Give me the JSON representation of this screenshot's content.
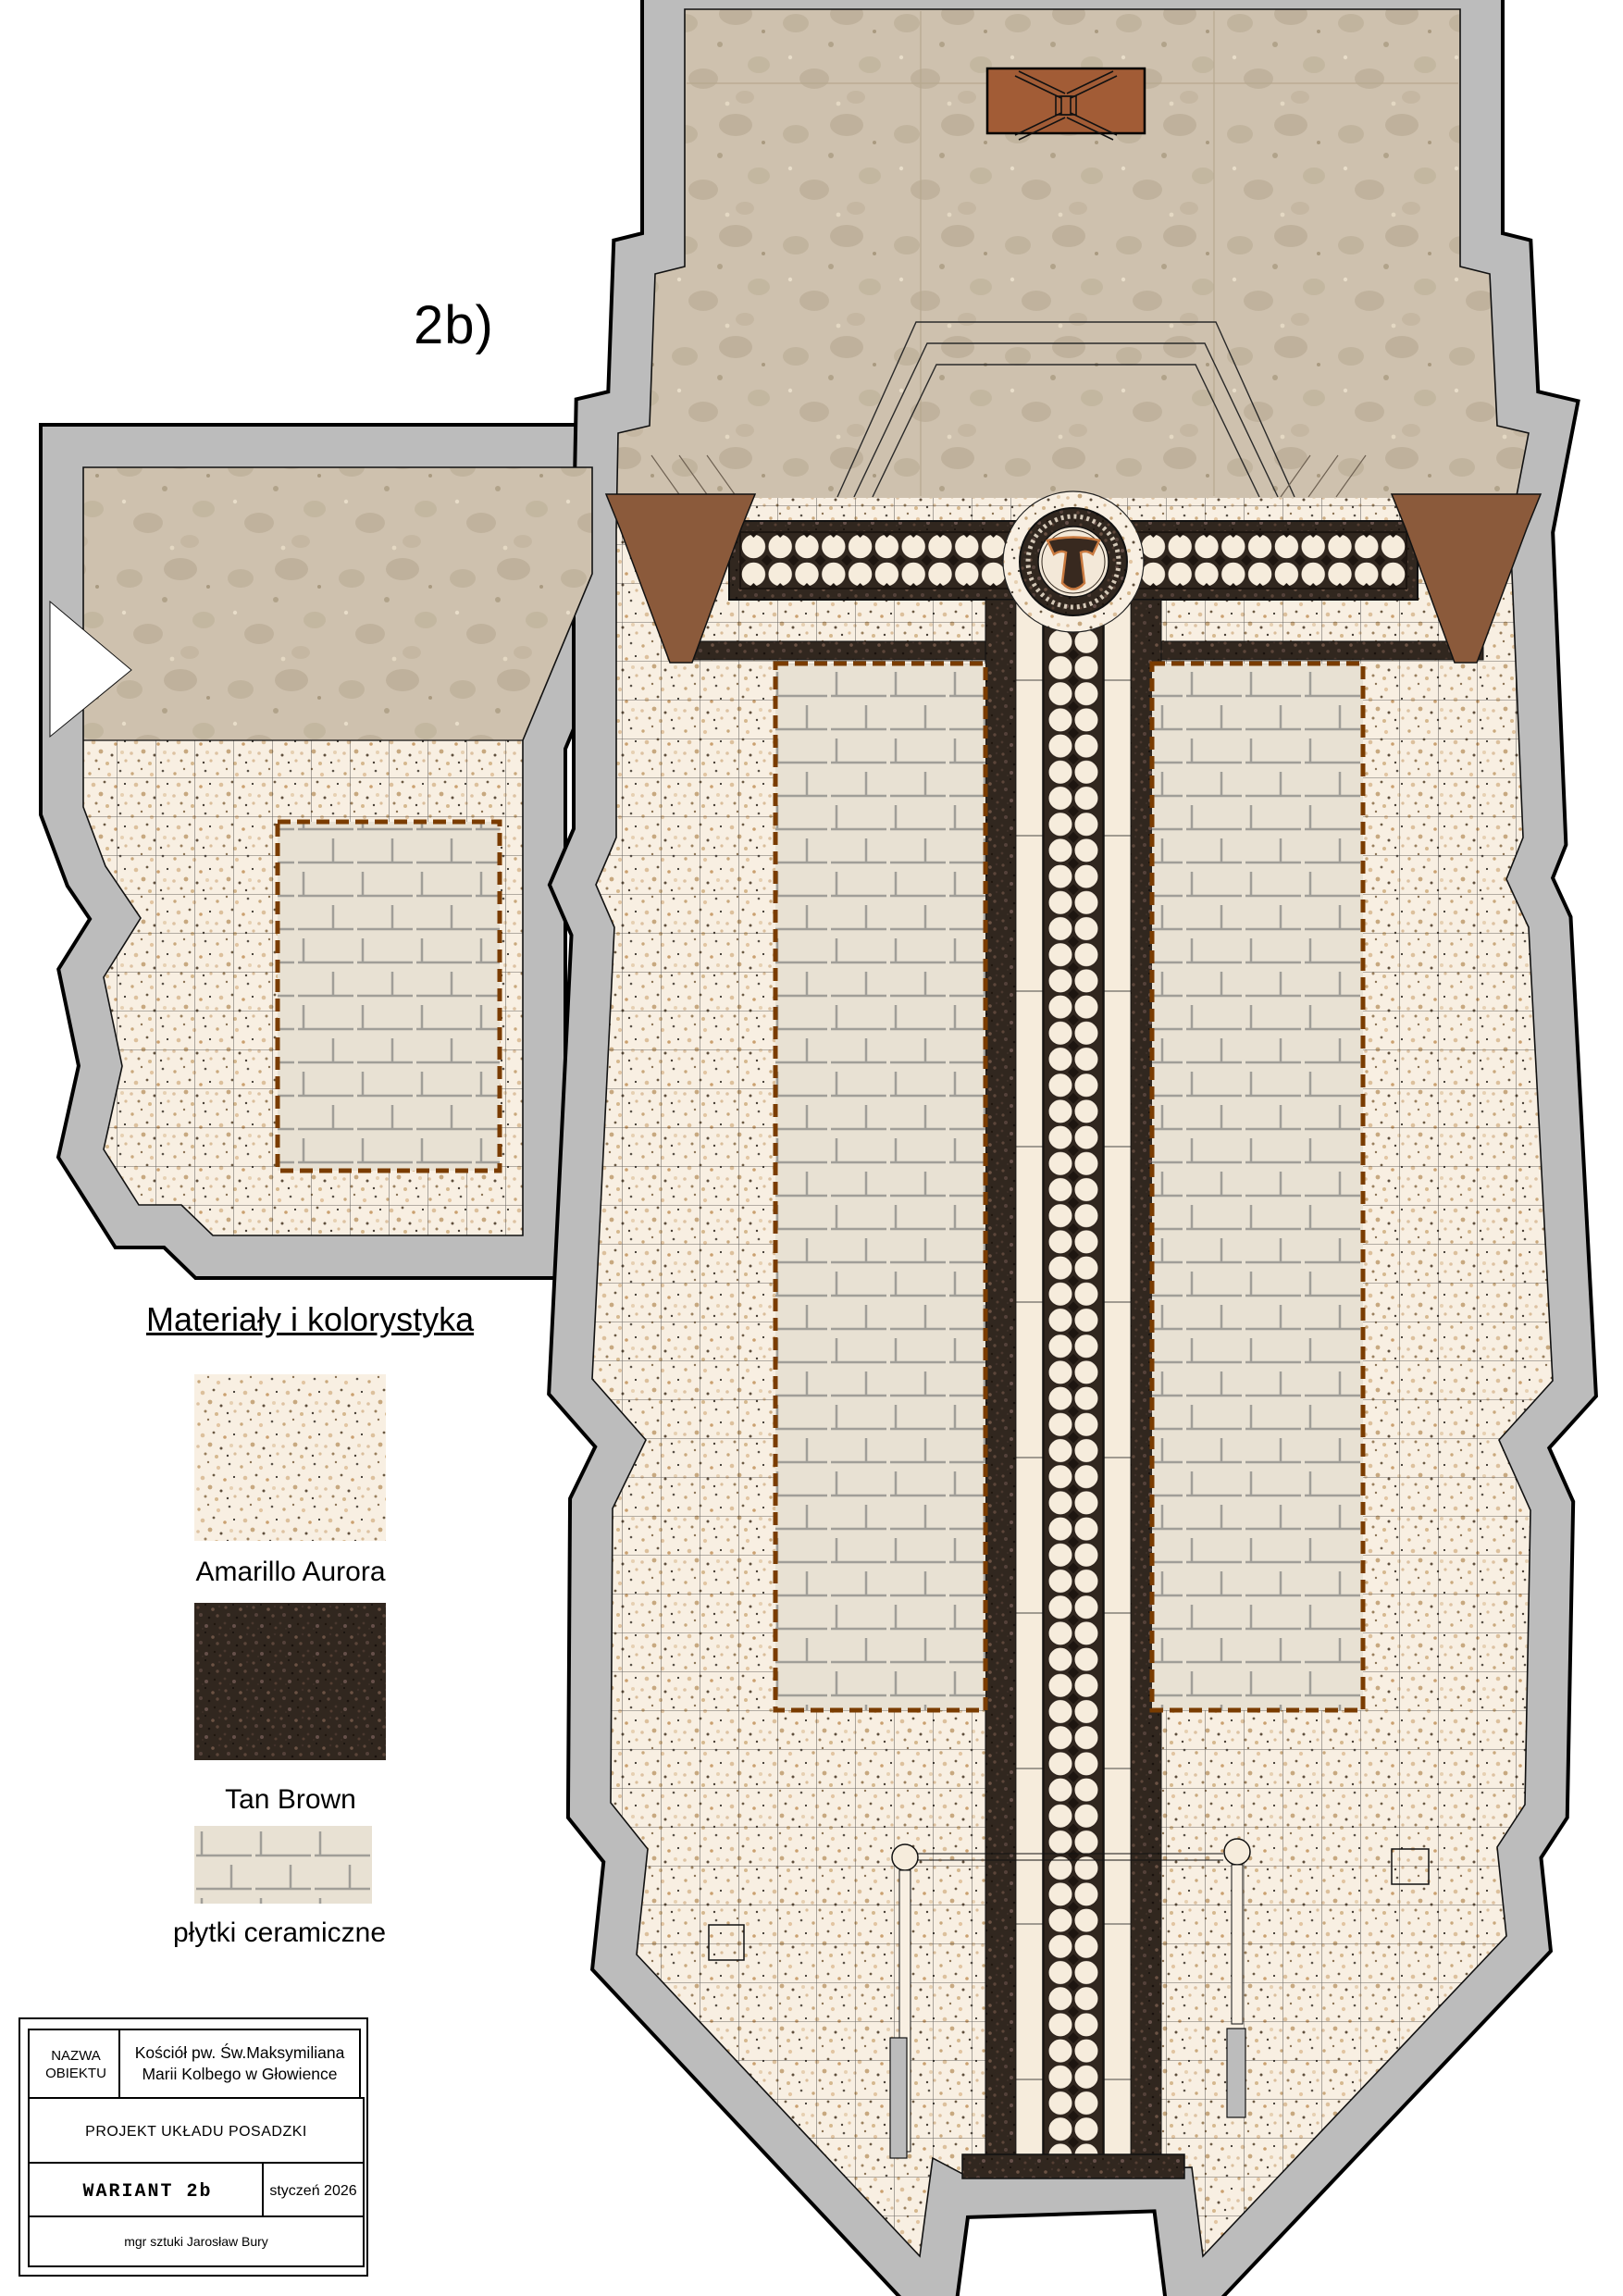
{
  "variant_label": "2b)",
  "legend": {
    "title": "Materiały i kolorystyka",
    "materials": [
      {
        "name": "Amarillo Aurora",
        "swatch": "granite-light-swatch"
      },
      {
        "name": "Tan Brown",
        "swatch": "granite-dark-swatch"
      },
      {
        "name": "płytki ceramiczne",
        "swatch": "ceramic-tiles-swatch"
      }
    ]
  },
  "title_block": {
    "object_label": "NAZWA OBIEKTU",
    "object_name": "Kościół pw. Św.Maksymiliana Marii Kolbego w Głowience",
    "project_title": "PROJEKT UKŁADU POSADZKI",
    "variant": "WARIANT 2b",
    "date": "styczeń 2026",
    "author": "mgr sztuki Jarosław Bury"
  },
  "colors": {
    "wall_gray": "#bcbcbc",
    "limestone_beige": "#cec1ae",
    "granite_light": "#f8efe2",
    "granite_dark": "#31271f",
    "ceramic_tile": "#e8e1d3",
    "furniture_brown": "#a25c36",
    "trapezoid_brown": "#8b5a3b",
    "dashed_border_brown": "#7a3c00"
  }
}
